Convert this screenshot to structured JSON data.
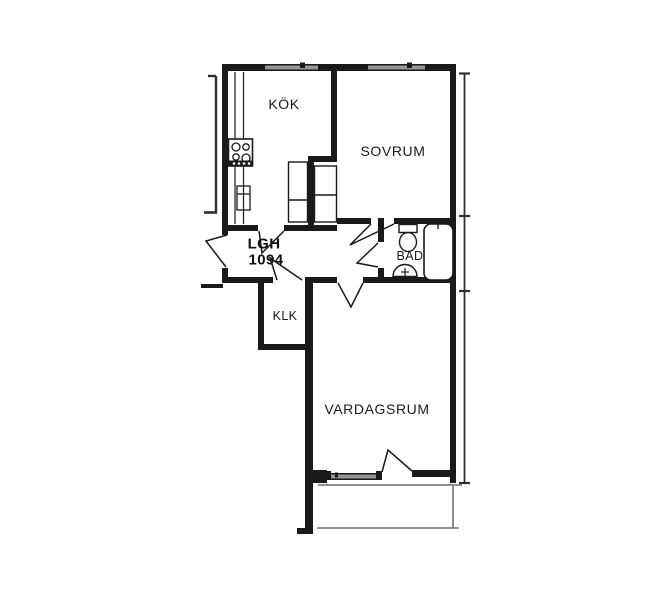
{
  "floor_plan": {
    "apartment": {
      "label_line1": "LGH",
      "label_line2": "1094"
    },
    "rooms": [
      {
        "id": "kok",
        "label": "KÖK"
      },
      {
        "id": "sovrum",
        "label": "SOVRUM"
      },
      {
        "id": "bad",
        "label": "BAD"
      },
      {
        "id": "klk",
        "label": "KLK"
      },
      {
        "id": "vardagsrum",
        "label": "VARDAGSRUM"
      }
    ],
    "fixtures": [
      {
        "id": "stove",
        "name": "stove-4-burners"
      },
      {
        "id": "kitchen-counter",
        "name": "kitchen-counter"
      },
      {
        "id": "sink-cabinet",
        "name": "sink-cabinet"
      },
      {
        "id": "wardrobe-1",
        "name": "wardrobe"
      },
      {
        "id": "wardrobe-2",
        "name": "wardrobe"
      },
      {
        "id": "toilet",
        "name": "toilet"
      },
      {
        "id": "wash-basin",
        "name": "wash-basin"
      },
      {
        "id": "bathtub",
        "name": "bathtub"
      }
    ],
    "openings": {
      "window_count": 3,
      "door_count": 7,
      "has_balcony": true
    },
    "colors": {
      "wall": "#1a1a1a",
      "window_fill": "#969696",
      "balcony_line": "#6e6e6e",
      "section_line": "#2e2e2e",
      "text": "#1a1a1a",
      "background": "#ffffff"
    }
  }
}
